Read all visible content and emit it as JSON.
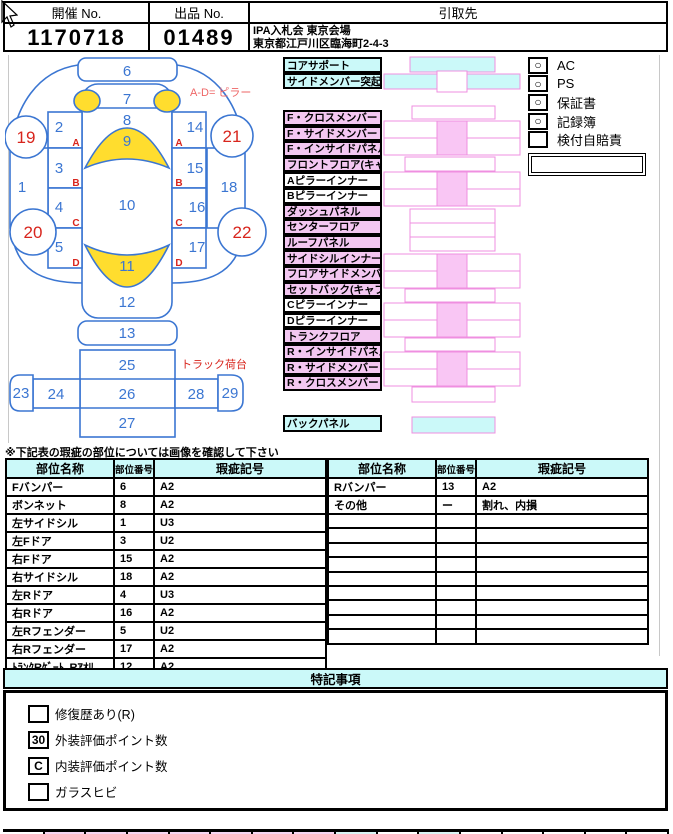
{
  "header": {
    "cols": [
      {
        "label": "開催 No.",
        "value": "1170718"
      },
      {
        "label": "出品 No.",
        "value": "01489"
      },
      {
        "label": "引取先",
        "value_line1": "IPA入札会 東京会場",
        "value_line2": "東京都江戸川区臨海町2-4-3"
      }
    ]
  },
  "car": {
    "pillar_note": "A-D= ピラー",
    "truck_note": "トラック荷台",
    "zones": {
      "1": "1",
      "2": "2",
      "3": "3",
      "4": "4",
      "5": "5",
      "6": "6",
      "7": "7",
      "8": "8",
      "9": "9",
      "10": "10",
      "11": "11",
      "12": "12",
      "13": "13",
      "14": "14",
      "15": "15",
      "16": "16",
      "17": "17",
      "18": "18",
      "19": "19",
      "20": "20",
      "21": "21",
      "22": "22",
      "23": "23",
      "24": "24",
      "25": "25",
      "26": "26",
      "27": "27",
      "28": "28",
      "29": "29"
    },
    "pillars": {
      "A": "A",
      "B": "B",
      "C": "C",
      "D": "D"
    }
  },
  "parts": {
    "group1": [
      {
        "label": "コアサポート",
        "type": "cyan"
      },
      {
        "label": "サイドメンバー突起部",
        "type": "cyan"
      }
    ],
    "group2": [
      {
        "label": "F・クロスメンバー",
        "type": "pink"
      },
      {
        "label": "F・サイドメンバー",
        "type": "pink"
      },
      {
        "label": "F・インサイドパネル",
        "type": "pink"
      },
      {
        "label": "フロントフロア(キャブ床)",
        "type": "pink"
      },
      {
        "label": "Aピラーインナー",
        "type": "white"
      },
      {
        "label": "Bピラーインナー",
        "type": "white"
      },
      {
        "label": "ダッシュパネル",
        "type": "pink"
      },
      {
        "label": "センターフロア",
        "type": "pink"
      },
      {
        "label": "ルーフパネル",
        "type": "pink"
      },
      {
        "label": "サイドシルインナー",
        "type": "pink"
      },
      {
        "label": "フロアサイドメンバー",
        "type": "pink"
      },
      {
        "label": "セットバック(キャブ背)",
        "type": "pink"
      },
      {
        "label": "Cピラーインナー",
        "type": "white"
      },
      {
        "label": "Dピラーインナー",
        "type": "white"
      },
      {
        "label": "トランクフロア",
        "type": "pink"
      },
      {
        "label": "R・インサイドパネル",
        "type": "pink"
      },
      {
        "label": "R・サイドメンバー",
        "type": "pink"
      },
      {
        "label": "R・クロスメンバー",
        "type": "pink"
      }
    ],
    "group3": [
      {
        "label": "バックパネル",
        "type": "cyan"
      }
    ]
  },
  "options": [
    {
      "label": "AC",
      "mark": "○"
    },
    {
      "label": "PS",
      "mark": "○"
    },
    {
      "label": "保証書",
      "mark": "○"
    },
    {
      "label": "記録簿",
      "mark": "○"
    },
    {
      "label": "検付自賠責",
      "mark": ""
    }
  ],
  "note": "※下記表の瑕疵の部位については画像を確認して下さい",
  "defect_table": {
    "headers": [
      "部位名称",
      "部位番号",
      "瑕疵記号"
    ],
    "left_rows": [
      [
        "Fバンパー",
        "6",
        "A2"
      ],
      [
        "ボンネット",
        "8",
        "A2"
      ],
      [
        "左サイドシル",
        "1",
        "U3"
      ],
      [
        "左Fドア",
        "3",
        "U2"
      ],
      [
        "右Fドア",
        "15",
        "A2"
      ],
      [
        "右サイドシル",
        "18",
        "A2"
      ],
      [
        "左Rドア",
        "4",
        "U3"
      ],
      [
        "右Rドア",
        "16",
        "A2"
      ],
      [
        "左Rフェンダー",
        "5",
        "U2"
      ],
      [
        "右Rフェンダー",
        "17",
        "A2"
      ],
      [
        "ﾄﾗﾝｸRｹﾞｰﾄ､Rｱｵﾘ",
        "12",
        "A2"
      ]
    ],
    "right_rows": [
      [
        "Rバンパー",
        "13",
        "A2"
      ],
      [
        "その他",
        "ー",
        "割れ、内損"
      ],
      [
        "",
        "",
        ""
      ],
      [
        "",
        "",
        ""
      ],
      [
        "",
        "",
        ""
      ],
      [
        "",
        "",
        ""
      ],
      [
        "",
        "",
        ""
      ],
      [
        "",
        "",
        ""
      ],
      [
        "",
        "",
        ""
      ],
      [
        "",
        "",
        ""
      ],
      [
        "",
        "",
        ""
      ]
    ]
  },
  "special": {
    "title": "特記事項",
    "items": [
      {
        "box": "",
        "label": "修復歴あり(R)"
      },
      {
        "box": "30",
        "label": "外装評価ポイント数"
      },
      {
        "box": "C",
        "label": "内装評価ポイント数"
      },
      {
        "box": "",
        "label": "ガラスヒビ"
      }
    ]
  },
  "colors": {
    "cyan": "#cbf9f9",
    "pink_label": "#f3c7f1",
    "pink_fill": "#f9c6f4",
    "pink_stroke": "#ef8fe0",
    "blue": "#3b76d2",
    "red": "#d8251d",
    "yellow": "#ffdd2e"
  }
}
